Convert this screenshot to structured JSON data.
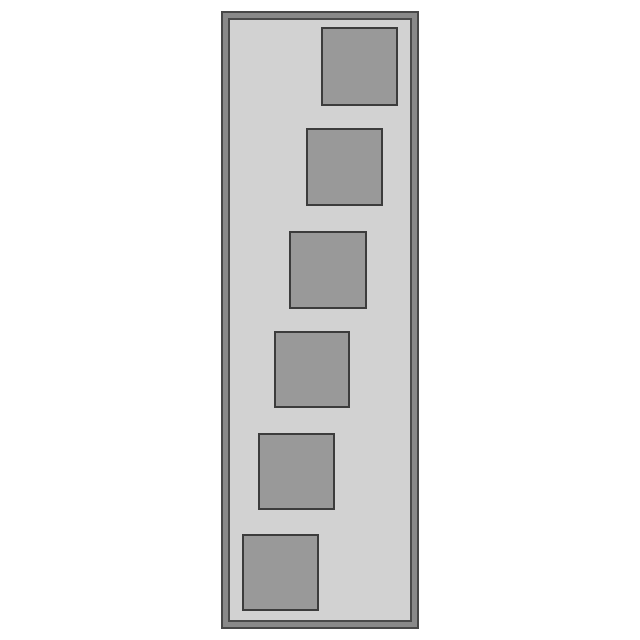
{
  "canvas": {
    "width": 640,
    "height": 640,
    "background": "#ffffff"
  },
  "panel": {
    "x": 221,
    "y": 11,
    "width": 198,
    "height": 618,
    "frame_band_color": "#898989",
    "frame_outline_color": "#474747",
    "interior_background": "#d2d2d2",
    "interior_outline_color": "#4a4a4a"
  },
  "square_style": {
    "fill": "#999999",
    "outline": "#3c3c3c"
  },
  "squares": [
    {
      "x": 321,
      "y": 27,
      "width": 77,
      "height": 79
    },
    {
      "x": 306,
      "y": 128,
      "width": 77,
      "height": 78
    },
    {
      "x": 289,
      "y": 231,
      "width": 78,
      "height": 78
    },
    {
      "x": 274,
      "y": 331,
      "width": 76,
      "height": 77
    },
    {
      "x": 258,
      "y": 433,
      "width": 77,
      "height": 77
    },
    {
      "x": 242,
      "y": 534,
      "width": 77,
      "height": 77
    }
  ]
}
